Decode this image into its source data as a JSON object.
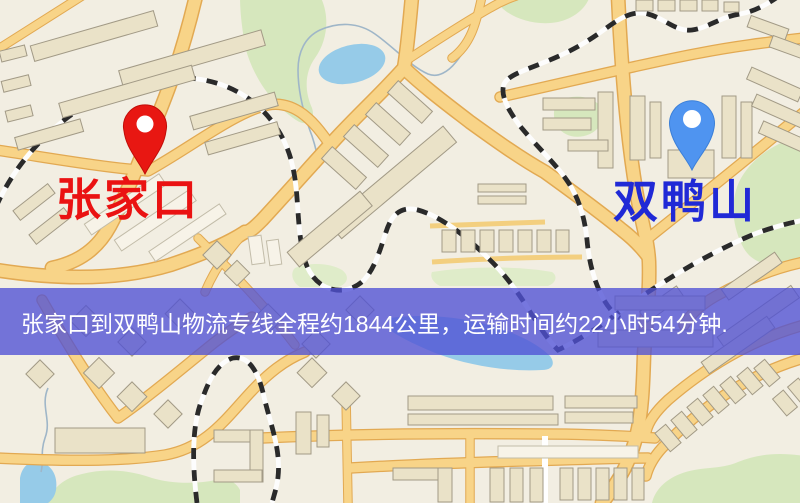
{
  "origin_marker": {
    "label": "张家口",
    "pin_icon": "red-map-pin",
    "pin_color": "#e81712",
    "label_color": "#ea1212"
  },
  "destination_marker": {
    "label": "双鸭山",
    "pin_icon": "blue-map-pin",
    "pin_color": "#4f94f0",
    "label_color": "#2029d6"
  },
  "banner": {
    "text": "张家口到双鸭山物流专线全程约1844公里，运输时间约22小时54分钟.",
    "bg_color": "rgba(79,81,213,0.78)",
    "text_color": "#ffffff"
  },
  "map_colors": {
    "background": "#f2eee2",
    "road_fill": "#f8d488",
    "road_casing": "#e2a952",
    "building": "#eae2c8",
    "green_area": "#d6e7bd",
    "water": "#96cbe8",
    "railway_dash": "#2a2a2a"
  }
}
